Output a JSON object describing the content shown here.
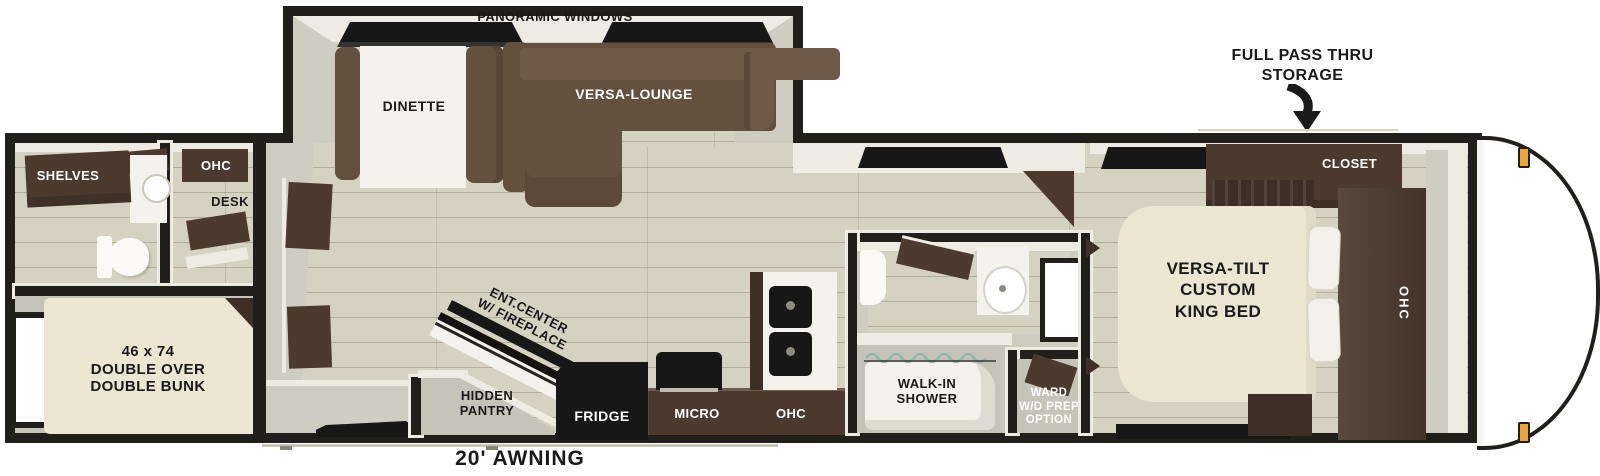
{
  "title": "Travel trailer floor plan",
  "slideout": {
    "panoramic_windows": "PANORAMIC WINDOWS",
    "dinette": "DINETTE",
    "versa_lounge": "VERSA-LOUNGE"
  },
  "rear": {
    "shelves": "SHELVES",
    "ohc": "OHC",
    "desk": "DESK",
    "bunk": [
      "46 x 74",
      "DOUBLE OVER",
      "DOUBLE BUNK"
    ]
  },
  "kitchen": {
    "ent_center": [
      "ENT.CENTER",
      "W/ FIREPLACE"
    ],
    "hidden_pantry": [
      "HIDDEN",
      "PANTRY"
    ],
    "fridge": "FRIDGE",
    "micro": "MICRO",
    "ohc": "OHC"
  },
  "bathroom": {
    "walk_in_shower": [
      "WALK-IN",
      "SHOWER"
    ],
    "ward": [
      "WARD",
      "W/D PREP",
      "OPTION"
    ]
  },
  "bedroom": {
    "closet": "CLOSET",
    "king_bed": [
      "VERSA-TILT",
      "CUSTOM",
      "KING BED"
    ],
    "ohc": "OHC"
  },
  "exterior": {
    "full_pass_thru": [
      "FULL PASS THRU",
      "STORAGE"
    ],
    "awning": "20' AWNING"
  },
  "colors": {
    "wall_black": "#211f1c",
    "trim_white": "#eeebe2",
    "floor_wood": "#d6d2c1",
    "wall_gray": "#cfccc1",
    "room_gray": "#c6c3b8",
    "sofa_brown": "#64503f",
    "sofa_brown_light": "#6f5a48",
    "cabinet_brown": "#4c3a2f",
    "cabinet_brown_dark": "#3e2f26",
    "bed_beige": "#eae6d2",
    "object_white": "#f4f2ec",
    "appliance_black": "#171717",
    "marker_amber": "#eaa63c",
    "glass_teal": "#8fb8ae",
    "hitch_gray": "#434246",
    "label_black": "#1a1a1a",
    "label_white": "#ffffff"
  }
}
